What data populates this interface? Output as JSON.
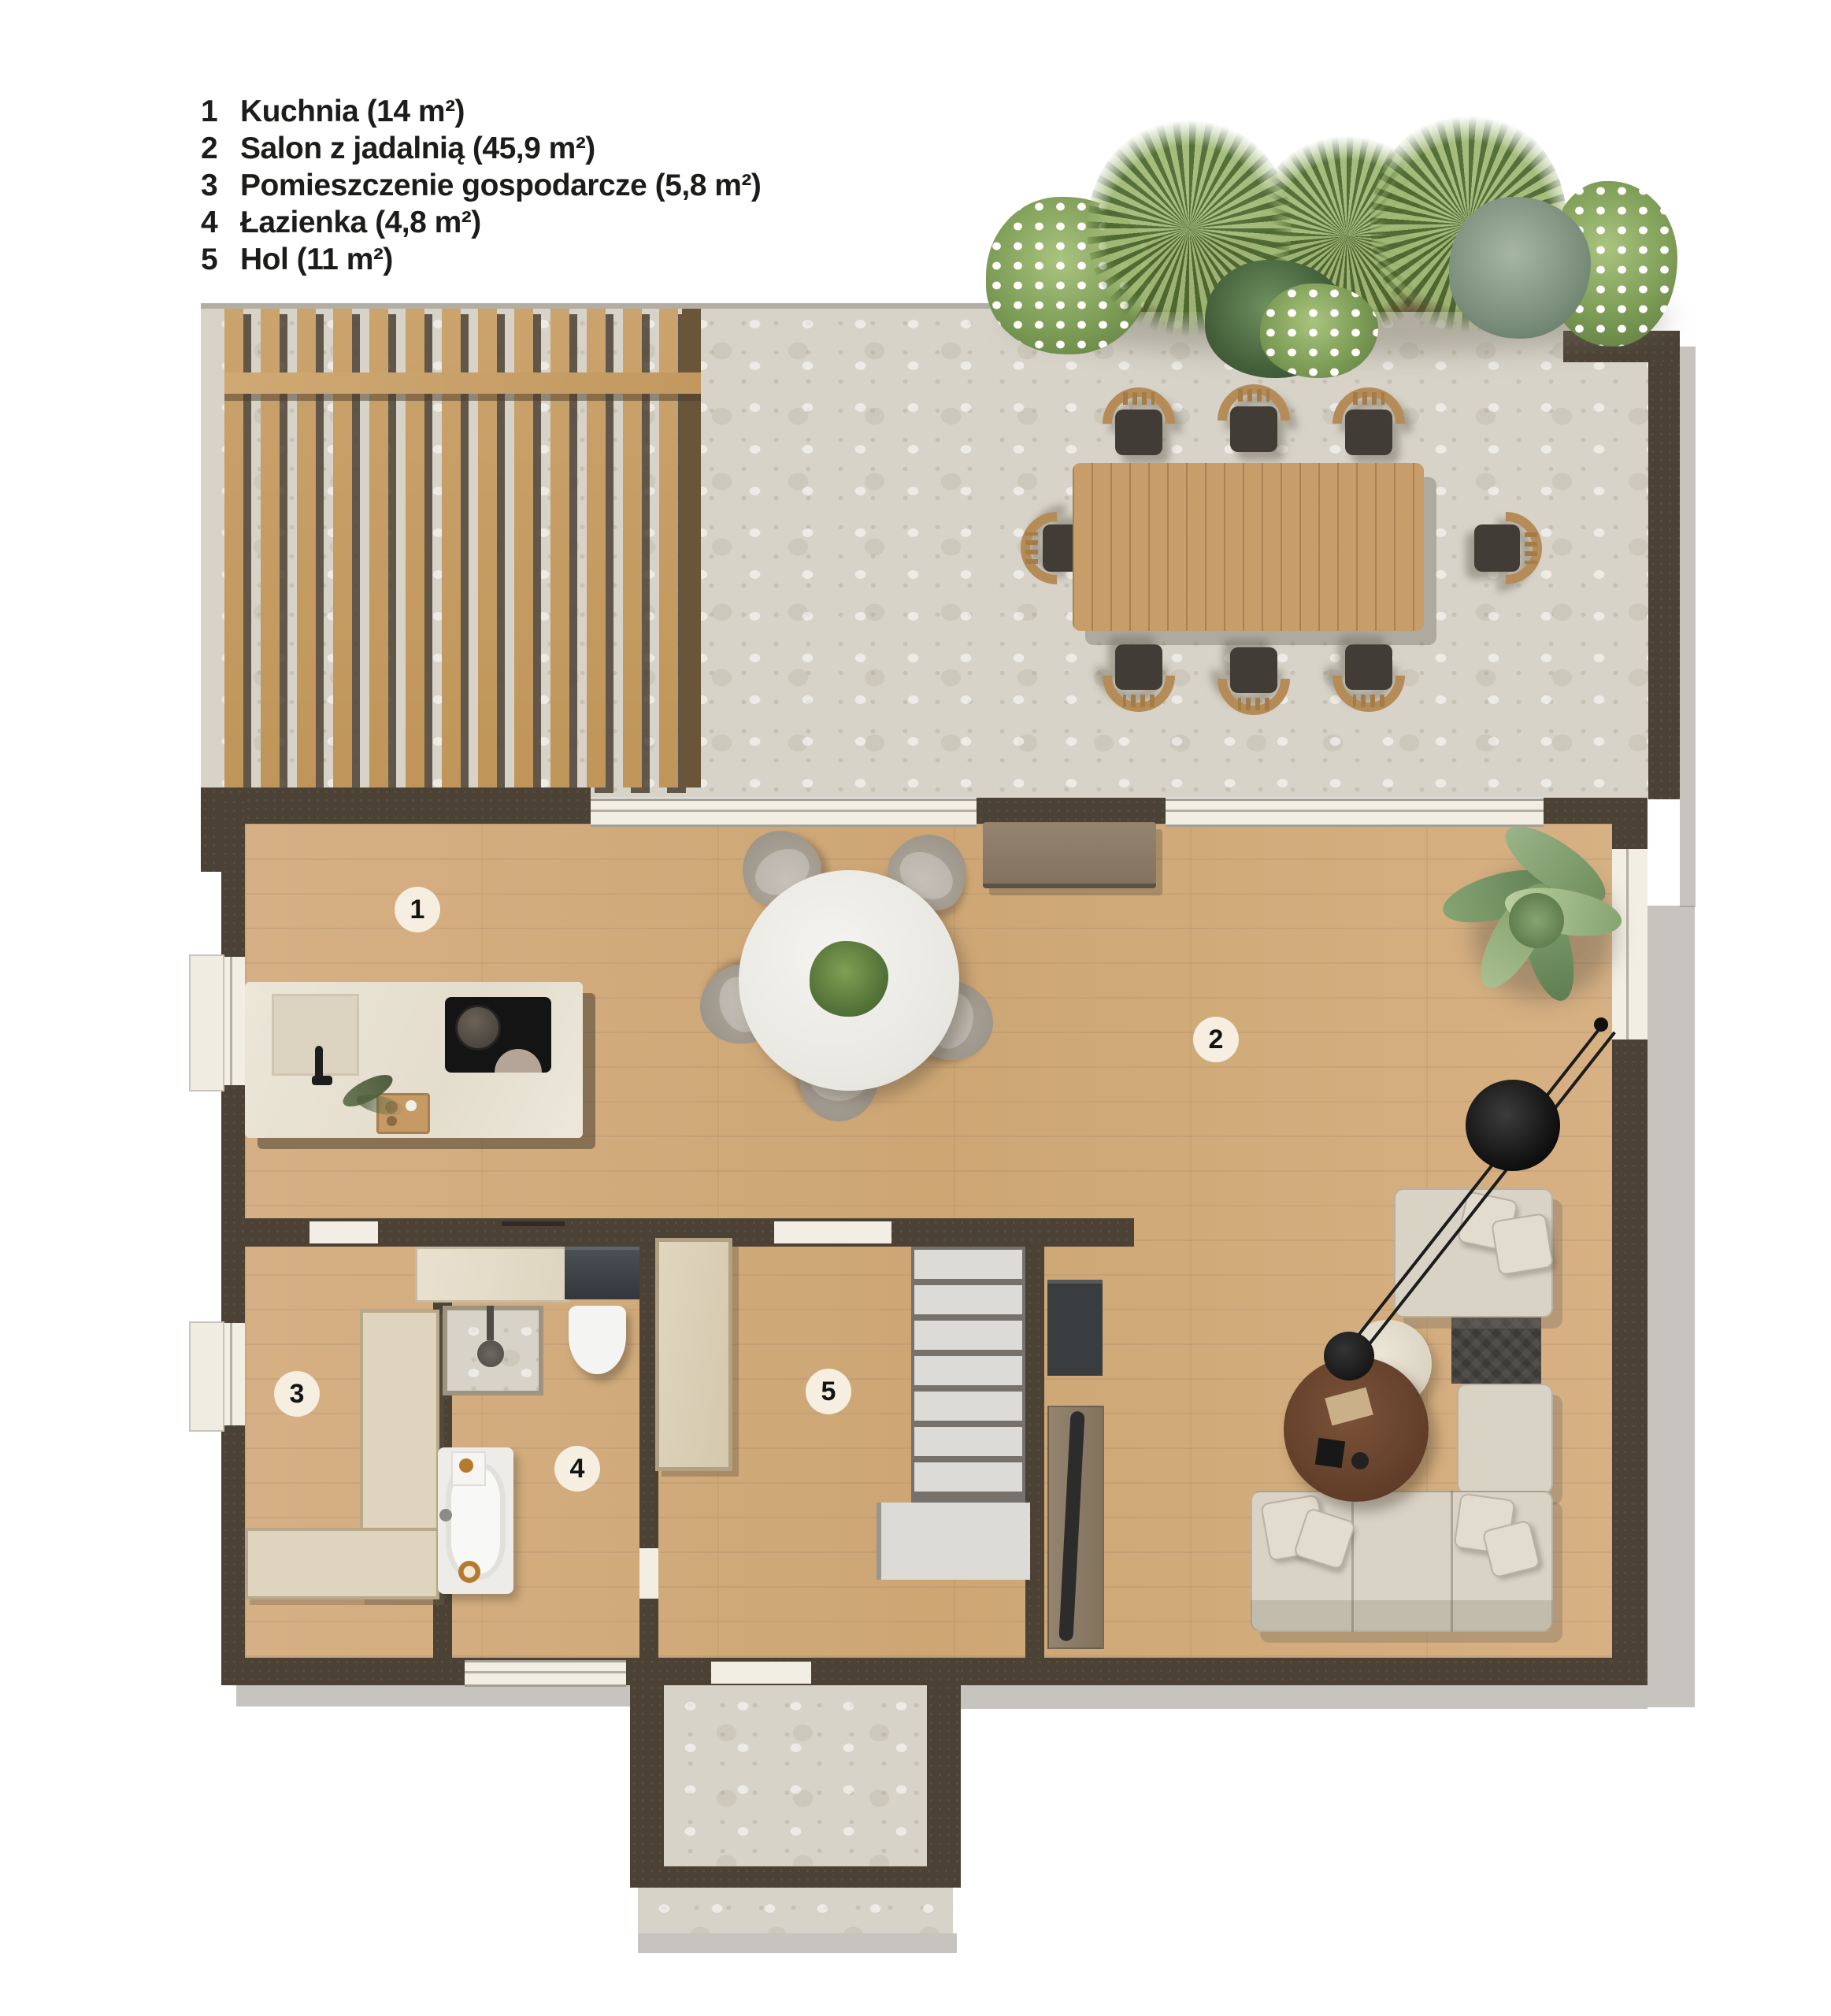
{
  "title": "Rzut parteru — plan mieszkania",
  "legend": {
    "items": [
      {
        "num": "1",
        "label": "Kuchnia (14 m²)"
      },
      {
        "num": "2",
        "label": "Salon z jadalnią (45,9 m²)"
      },
      {
        "num": "3",
        "label": "Pomieszczenie gospodarcze (5,8 m²)"
      },
      {
        "num": "4",
        "label": "Łazienka (4,8 m²)"
      },
      {
        "num": "5",
        "label": "Hol (11 m²)"
      }
    ]
  },
  "room_markers": [
    {
      "number": "1",
      "room": "Kuchnia"
    },
    {
      "number": "2",
      "room": "Salon z jadalnią"
    },
    {
      "number": "3",
      "room": "Pomieszczenie gospodarcze"
    },
    {
      "number": "4",
      "room": "Łazienka"
    },
    {
      "number": "5",
      "room": "Hol"
    }
  ],
  "colors": {
    "wall": "#4b4235",
    "wood_floor": "#d2a97a",
    "stone": "#d7d3c8",
    "counter_marble": "#eae4d6",
    "sofa_beige": "#d9d3c5",
    "rug_dark": "#3b3a37",
    "plant_green": "#7d9c55",
    "badge_bg": "#f5eee1"
  }
}
